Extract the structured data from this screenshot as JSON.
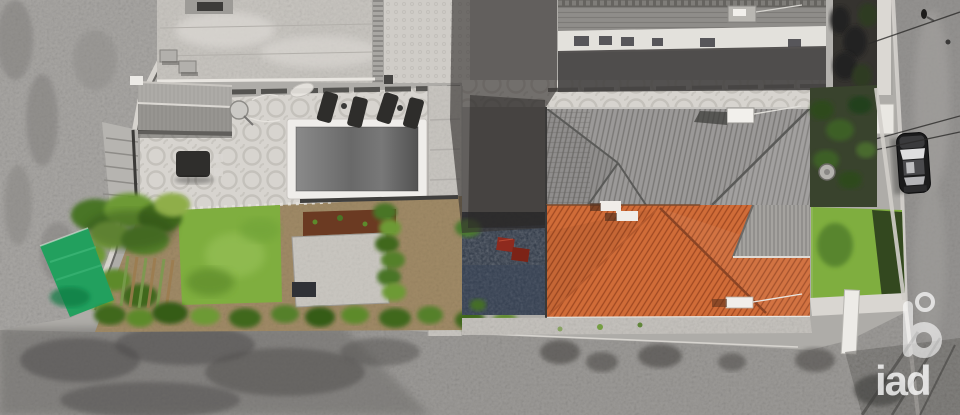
{
  "watermark": {
    "brand": "iad"
  },
  "colors": {
    "roof_orange": "#d06c38",
    "roof_orange_dark": "#a14a22",
    "roof_gray": "#9b9998",
    "roof_gray_dark": "#7a7876",
    "patio_light": "#d7d4cf",
    "lawn_green": "#7fae3f",
    "tarp_green": "#22a05e",
    "mulch_brown": "#6b3a22",
    "furniture_red": "#8e2a1e",
    "courtyard_navy": "#2b3442",
    "watermark_white": "#ffffff"
  }
}
